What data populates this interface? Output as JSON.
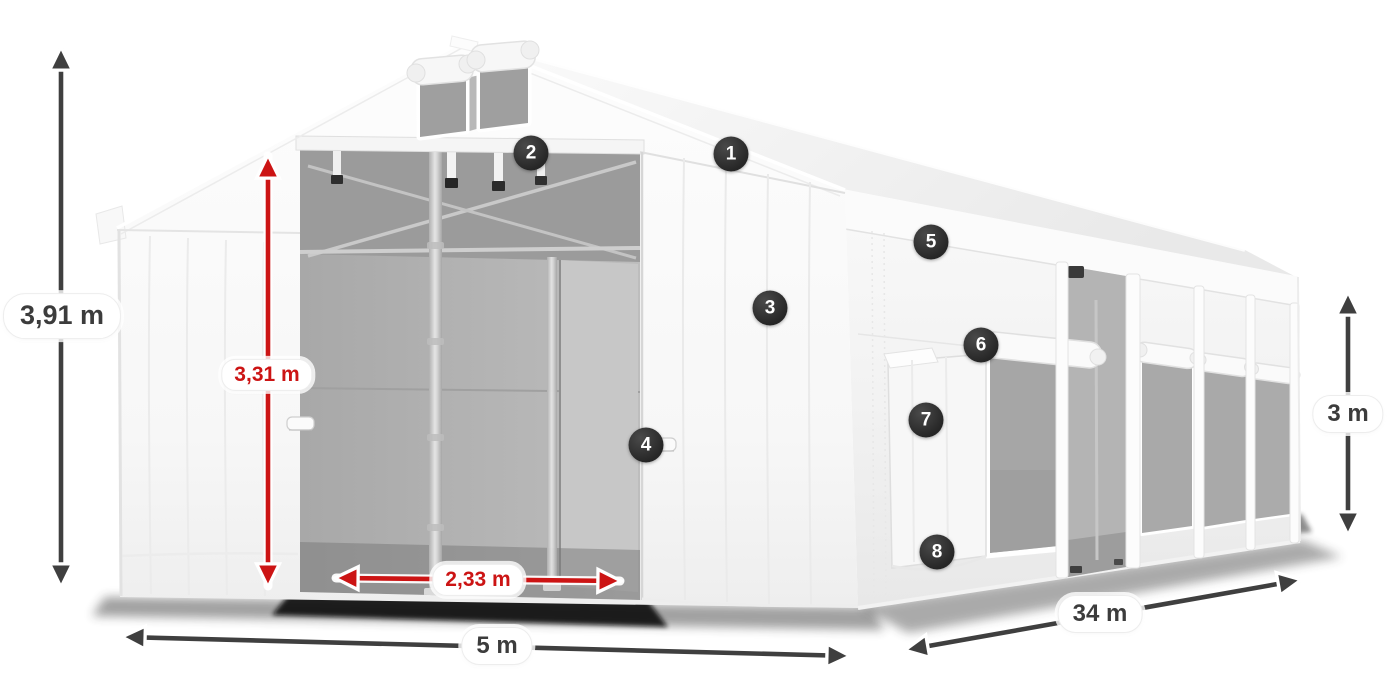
{
  "figure": {
    "title": "Tent dimension diagram",
    "description": "White marquee storage tent shown in perspective with open front double doors, gable vent windows, side entrance, mesh windows and dimension annotations",
    "background": "#ffffff"
  },
  "colors": {
    "dimension-red": "#cc1414",
    "dimension-dark": "#3f3f3f",
    "badge-bg": "#262626",
    "badge-text": "#ffffff",
    "pill-bg": "#ffffff",
    "label-text": "#3c3c3c"
  },
  "dimensions": {
    "total_height": {
      "label": "3,91 m",
      "color": "dark",
      "orientation": "vertical"
    },
    "door_height": {
      "label": "3,31 m",
      "color": "red",
      "orientation": "vertical"
    },
    "door_width": {
      "label": "2,33 m",
      "color": "red",
      "orientation": "horizontal"
    },
    "front_width": {
      "label": "5 m",
      "color": "dark",
      "orientation": "horizontal"
    },
    "side_length": {
      "label": "34 m",
      "color": "dark",
      "orientation": "diagonal"
    },
    "side_height": {
      "label": "3 m",
      "color": "dark",
      "orientation": "vertical"
    }
  },
  "callouts": [
    {
      "number": "1"
    },
    {
      "number": "2"
    },
    {
      "number": "3"
    },
    {
      "number": "4"
    },
    {
      "number": "5"
    },
    {
      "number": "6"
    },
    {
      "number": "7"
    },
    {
      "number": "8"
    }
  ]
}
